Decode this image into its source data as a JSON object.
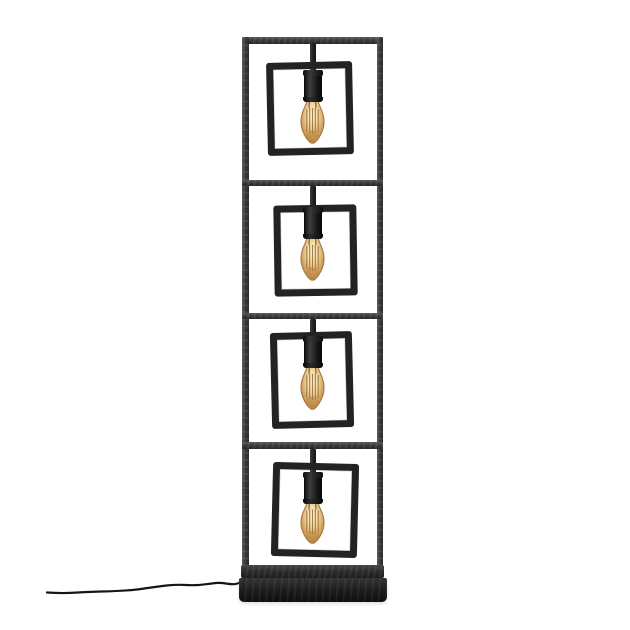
{
  "scene": {
    "type": "product-photo",
    "description": "Industrial black metal floor lamp with four stacked square frames, each holding a hanging socket with a lit amber Edison filament bulb, standing on a flat black plinth base with a power cord trailing to the left on a white background"
  },
  "colors": {
    "background": "#ffffff",
    "frame_light": "#5a5a5a",
    "frame_mid": "#3c3c3c",
    "frame_dark": "#262626",
    "square": "#232323",
    "socket": "#141414",
    "bulb_outline": "#a3763c",
    "bulb_glow": "#fbf3dc",
    "bulb_glass": "#eed9a6",
    "bulb_amber": "#d3a462",
    "bulb_deep": "#b5813f",
    "filament": "#9c6a2b",
    "base": "#1b1b1b",
    "cord": "#161616"
  },
  "lamp": {
    "bulb_count": 4,
    "frame_bars": [
      {
        "name": "outer-frame-top-bar",
        "orient": "h",
        "x": 242,
        "y": 37,
        "w": 141,
        "h": 6.5
      },
      {
        "name": "outer-frame-left-bar",
        "orient": "v",
        "x": 242,
        "y": 37,
        "w": 6.5,
        "h": 529
      },
      {
        "name": "outer-frame-right-bar",
        "orient": "v",
        "x": 376.5,
        "y": 37,
        "w": 6.5,
        "h": 529
      },
      {
        "name": "shelf-divider-1",
        "orient": "h",
        "x": 242,
        "y": 179.5,
        "w": 141,
        "h": 6.5
      },
      {
        "name": "shelf-divider-2",
        "orient": "h",
        "x": 242,
        "y": 312.5,
        "w": 141,
        "h": 6.5
      },
      {
        "name": "shelf-divider-3",
        "orient": "h",
        "x": 242,
        "y": 442,
        "w": 141,
        "h": 6.5
      }
    ],
    "base": {
      "plate": {
        "x": 240.5,
        "y": 565,
        "w": 143,
        "h": 13
      },
      "plinth": {
        "x": 239,
        "y": 577.5,
        "w": 148,
        "h": 24
      }
    },
    "sections": [
      {
        "rod": {
          "x": 309.5,
          "y": 43,
          "w": 6.5,
          "h": 32
        },
        "square": {
          "x": 267,
          "y": 62,
          "w": 86,
          "h": 93,
          "rot": -1.2
        },
        "socket": {
          "x": 304,
          "y": 72,
          "w": 17.5,
          "h": 28
        },
        "bulb": {
          "x": 297,
          "y": 97,
          "w": 31,
          "h": 49
        }
      },
      {
        "rod": {
          "x": 309.5,
          "y": 186,
          "w": 6.5,
          "h": 26
        },
        "square": {
          "x": 274,
          "y": 205,
          "w": 83,
          "h": 91,
          "rot": -0.9
        },
        "socket": {
          "x": 304,
          "y": 209,
          "w": 17.5,
          "h": 28
        },
        "bulb": {
          "x": 297,
          "y": 234,
          "w": 31,
          "h": 49
        }
      },
      {
        "rod": {
          "x": 309.5,
          "y": 319,
          "w": 6.5,
          "h": 22
        },
        "square": {
          "x": 271,
          "y": 332,
          "w": 82,
          "h": 96,
          "rot": -1.4
        },
        "socket": {
          "x": 304,
          "y": 338,
          "w": 17.5,
          "h": 28
        },
        "bulb": {
          "x": 297,
          "y": 363,
          "w": 31,
          "h": 49
        }
      },
      {
        "rod": {
          "x": 309.5,
          "y": 448.5,
          "w": 6.5,
          "h": 28
        },
        "square": {
          "x": 272,
          "y": 463,
          "w": 86,
          "h": 94,
          "rot": 1.4
        },
        "socket": {
          "x": 304,
          "y": 474,
          "w": 17.5,
          "h": 28
        },
        "bulb": {
          "x": 297,
          "y": 499,
          "w": 31,
          "h": 47
        }
      }
    ],
    "cord": {
      "path": "M 243 580 C 235 588 227 582 216 583 C 206 584 199 586 186 585 C 170 584 156 587 141 589 C 120 592 97 591 78 592.5 C 65 593.5 54 593 47 592.5"
    }
  }
}
